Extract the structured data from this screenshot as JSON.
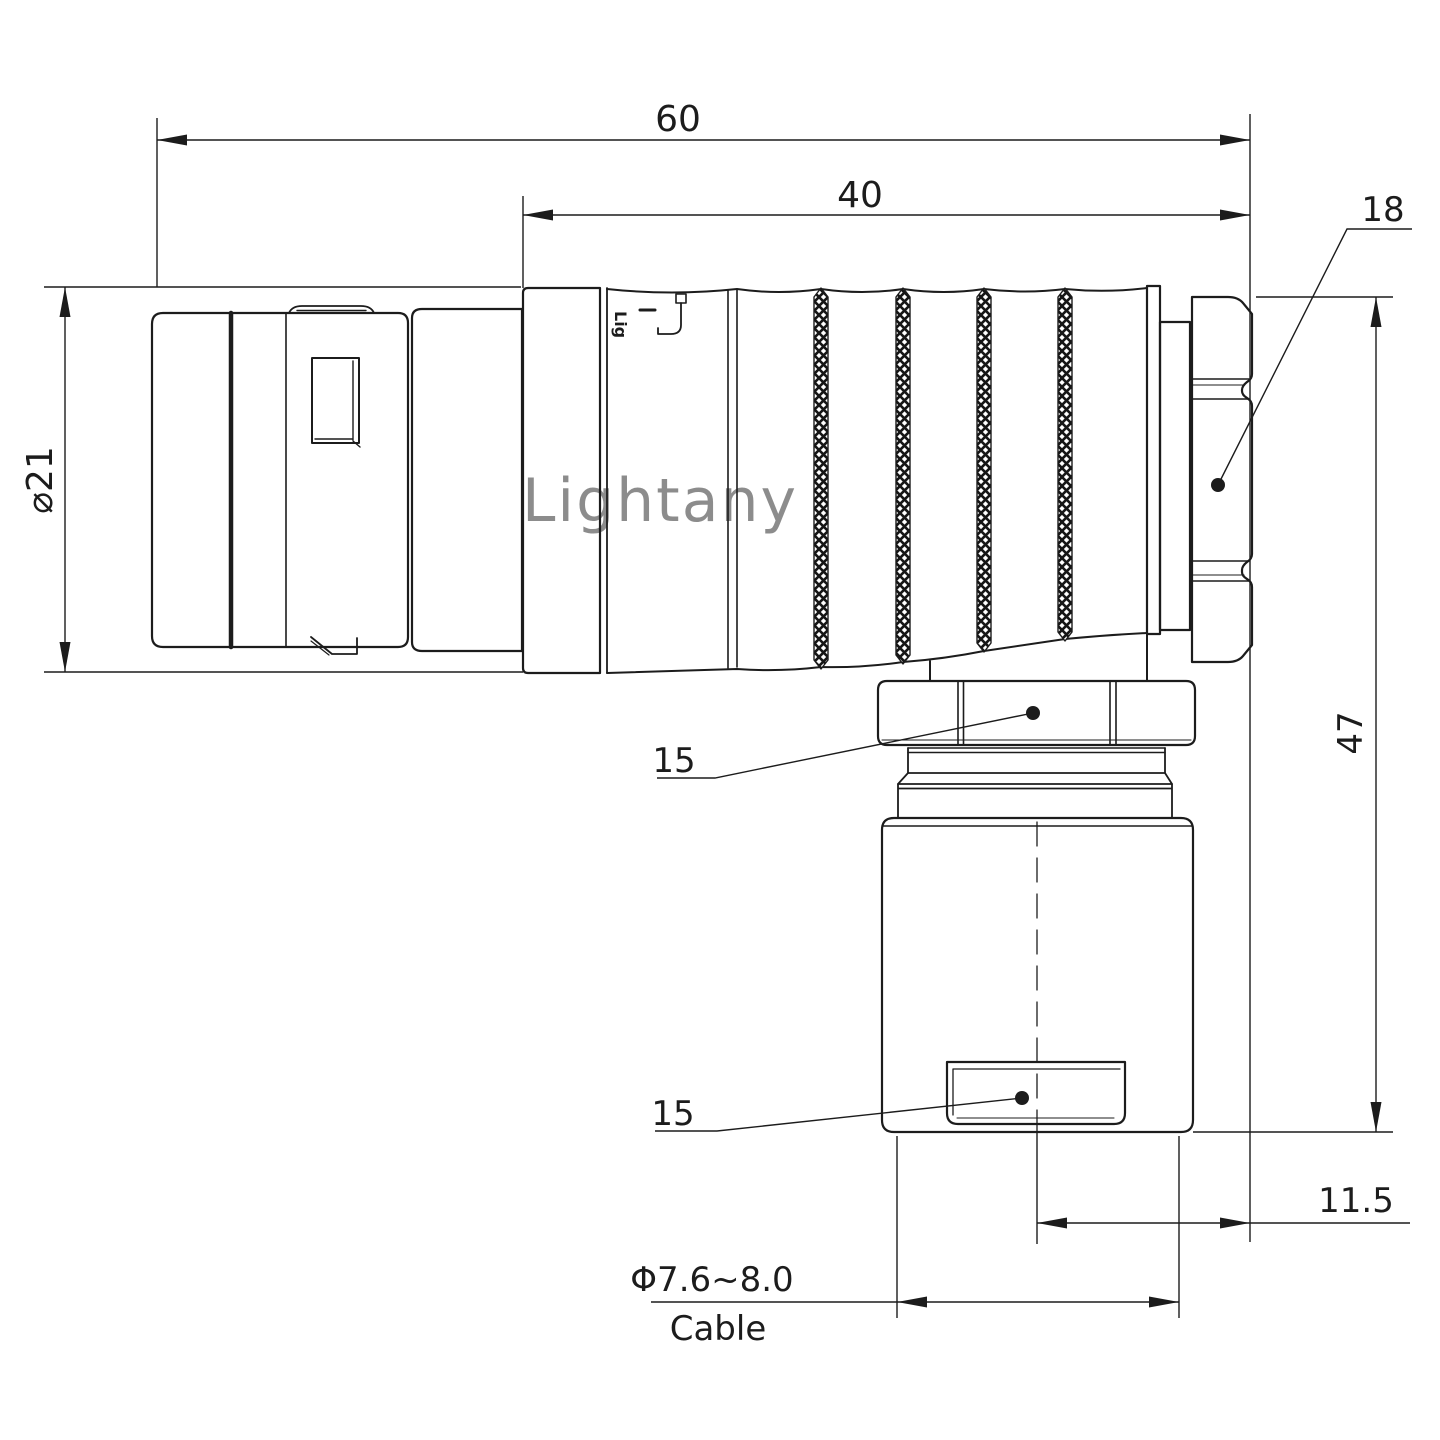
{
  "page": {
    "title": "connector-dimension-drawing",
    "background": "#ffffff",
    "line_color": "#1c1c1c"
  },
  "watermark": {
    "text": "Lightany",
    "color": "#f2c3c3"
  },
  "part_branding": {
    "text": "Lig"
  },
  "dimensions": {
    "overall_length": "60",
    "rear_length": "40",
    "backnut_callout": "18",
    "front_diameter": "⌀21",
    "overall_height": "47",
    "elbow_nut_callout": "15",
    "gland_nut_callout": "15",
    "center_offset": "11.5",
    "cable_diameter": "Φ7.6~8.0",
    "cable_word": "Cable"
  }
}
